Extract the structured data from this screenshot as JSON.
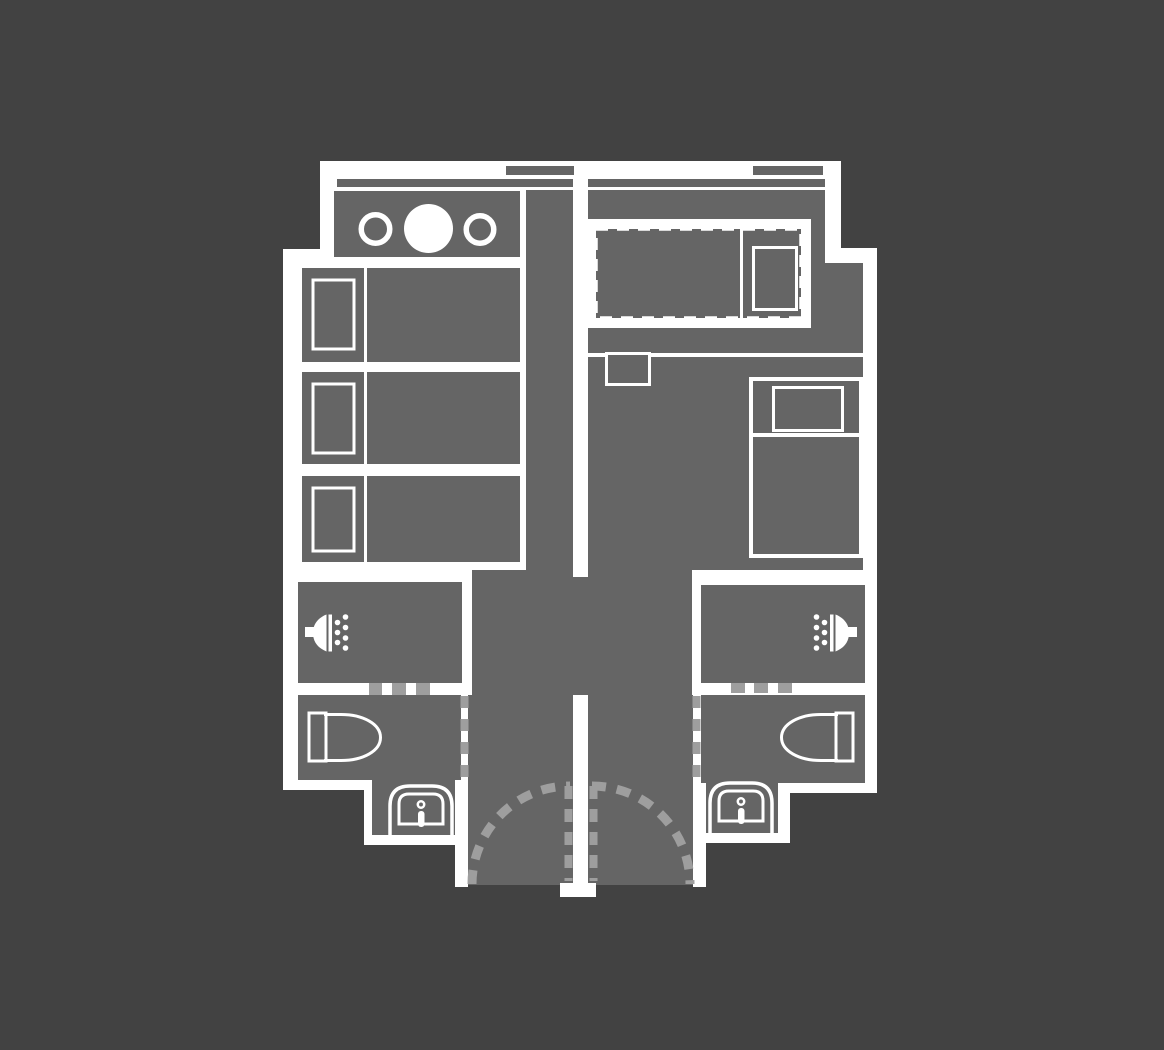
{
  "meta": {
    "description": "floor-plan-of-two-mirrored-suite-units",
    "canvas": {
      "width": 1164,
      "height": 1050
    }
  },
  "palette": {
    "background": "#424242",
    "wall_white": "#ffffff",
    "room_gray": "#656565",
    "dash_gray": "#9e9e9e"
  },
  "shapes": [
    {
      "name": "top-wall-band",
      "kind": "rect",
      "x": 320,
      "y": 161,
      "w": 521,
      "h": 29,
      "fill": "#ffffff"
    },
    {
      "name": "left-upper-floor-plate",
      "kind": "rect",
      "x": 320,
      "y": 190,
      "w": 253,
      "h": 59,
      "fill": "#ffffff"
    },
    {
      "name": "left-main-floor-plate",
      "kind": "rect",
      "x": 283,
      "y": 249,
      "w": 290,
      "h": 541,
      "fill": "#ffffff"
    },
    {
      "name": "left-sink-alcove-plate",
      "kind": "rect",
      "x": 364,
      "y": 780,
      "w": 104,
      "h": 65,
      "fill": "#ffffff"
    },
    {
      "name": "right-upper-floor-plate",
      "kind": "rect",
      "x": 573,
      "y": 190,
      "w": 268,
      "h": 58,
      "fill": "#ffffff"
    },
    {
      "name": "right-main-floor-plate",
      "kind": "rect",
      "x": 573,
      "y": 248,
      "w": 304,
      "h": 535,
      "fill": "#ffffff"
    },
    {
      "name": "right-sink-alcove-plate",
      "kind": "rect",
      "x": 693,
      "y": 783,
      "w": 97,
      "h": 60,
      "fill": "#ffffff"
    },
    {
      "name": "vestibule-upper-floor",
      "kind": "rect",
      "x": 472,
      "y": 570,
      "w": 220,
      "h": 125,
      "fill": "#656565"
    },
    {
      "name": "vestibule-lower-floor",
      "kind": "rect",
      "x": 468,
      "y": 695,
      "w": 225,
      "h": 190,
      "fill": "#656565"
    },
    {
      "name": "window-tab-left",
      "kind": "rect",
      "x": 506,
      "y": 166,
      "w": 68,
      "h": 9,
      "fill": "#656565"
    },
    {
      "name": "window-strip-left",
      "kind": "rect",
      "x": 337,
      "y": 179,
      "w": 236,
      "h": 8,
      "fill": "#656565"
    },
    {
      "name": "window-tab-right",
      "kind": "rect",
      "x": 753,
      "y": 166,
      "w": 70,
      "h": 9,
      "fill": "#656565"
    },
    {
      "name": "window-strip-right",
      "kind": "rect",
      "x": 588,
      "y": 179,
      "w": 237,
      "h": 8,
      "fill": "#656565"
    },
    {
      "name": "kitchen-counter",
      "kind": "rect",
      "x": 334,
      "y": 191,
      "w": 186,
      "h": 66,
      "fill": "#656565"
    },
    {
      "name": "left-hallway-floor",
      "kind": "rect",
      "x": 526,
      "y": 190,
      "w": 47,
      "h": 380,
      "fill": "#656565"
    },
    {
      "name": "left-bed-1",
      "kind": "rect",
      "x": 302,
      "y": 268,
      "w": 218,
      "h": 94,
      "fill": "#656565"
    },
    {
      "name": "left-bed-2",
      "kind": "rect",
      "x": 302,
      "y": 372,
      "w": 218,
      "h": 92,
      "fill": "#656565"
    },
    {
      "name": "left-bed-3",
      "kind": "rect",
      "x": 302,
      "y": 476,
      "w": 218,
      "h": 86,
      "fill": "#656565"
    },
    {
      "name": "right-room-upper-floor",
      "kind": "rect",
      "x": 588,
      "y": 190,
      "w": 237,
      "h": 73,
      "fill": "#656565"
    },
    {
      "name": "right-room-main-floor",
      "kind": "rect",
      "x": 588,
      "y": 263,
      "w": 275,
      "h": 307,
      "fill": "#656565"
    },
    {
      "name": "left-shower-room-floor",
      "kind": "rect",
      "x": 298,
      "y": 582,
      "w": 164,
      "h": 101,
      "fill": "#656565"
    },
    {
      "name": "right-shower-room-floor",
      "kind": "rect",
      "x": 701,
      "y": 585,
      "w": 164,
      "h": 98,
      "fill": "#656565"
    },
    {
      "name": "left-toilet-room-floor",
      "kind": "rect",
      "x": 298,
      "y": 695,
      "w": 163,
      "h": 85,
      "fill": "#656565"
    },
    {
      "name": "left-sink-alcove-floor",
      "kind": "rect",
      "x": 372,
      "y": 695,
      "w": 83,
      "h": 140,
      "fill": "#656565"
    },
    {
      "name": "right-toilet-room-floor",
      "kind": "rect",
      "x": 701,
      "y": 695,
      "w": 164,
      "h": 88,
      "fill": "#656565"
    },
    {
      "name": "right-sink-alcove-floor",
      "kind": "rect",
      "x": 701,
      "y": 695,
      "w": 77,
      "h": 138,
      "fill": "#656565"
    },
    {
      "name": "center-wall-upper",
      "kind": "rect",
      "x": 573,
      "y": 190,
      "w": 15,
      "h": 387,
      "fill": "#ffffff"
    },
    {
      "name": "center-wall-lower",
      "kind": "rect",
      "x": 573,
      "y": 695,
      "w": 15,
      "h": 192,
      "fill": "#ffffff"
    },
    {
      "name": "center-wall-foot",
      "kind": "rect",
      "x": 560,
      "y": 883,
      "w": 36,
      "h": 14,
      "fill": "#ffffff"
    },
    {
      "name": "left-entry-wall-stub",
      "kind": "rect",
      "x": 455,
      "y": 783,
      "w": 13,
      "h": 104,
      "fill": "#ffffff"
    },
    {
      "name": "right-entry-wall-stub",
      "kind": "rect",
      "x": 693,
      "y": 783,
      "w": 13,
      "h": 104,
      "fill": "#ffffff"
    },
    {
      "name": "right-toilet-room-bottom-wall",
      "kind": "rect",
      "x": 790,
      "y": 783,
      "w": 87,
      "h": 10,
      "fill": "#ffffff"
    },
    {
      "name": "stove-burner-ring-left",
      "kind": "circle",
      "cx": 375.5,
      "cy": 229,
      "r": 14.25,
      "fill": "none",
      "stroke": "#ffffff",
      "sw": 5.5
    },
    {
      "name": "stove-burner-disc-center",
      "kind": "circle",
      "cx": 428.5,
      "cy": 228.5,
      "r": 24.5,
      "fill": "#ffffff"
    },
    {
      "name": "stove-burner-ring-right",
      "kind": "circle",
      "cx": 480,
      "cy": 229.5,
      "r": 13.75,
      "fill": "none",
      "stroke": "#ffffff",
      "sw": 5.5
    },
    {
      "name": "left-bed-1-divider",
      "kind": "rect",
      "x": 364,
      "y": 268,
      "w": 3,
      "h": 94,
      "fill": "#ffffff"
    },
    {
      "name": "left-bed-2-divider",
      "kind": "rect",
      "x": 364,
      "y": 372,
      "w": 3,
      "h": 92,
      "fill": "#ffffff"
    },
    {
      "name": "left-bed-3-divider",
      "kind": "rect",
      "x": 364,
      "y": 476,
      "w": 3,
      "h": 86,
      "fill": "#ffffff"
    },
    {
      "name": "left-bed-1-pillow",
      "kind": "rect",
      "x": 313,
      "y": 280,
      "w": 41,
      "h": 69,
      "fill": "none",
      "stroke": "#ffffff",
      "sw": 3
    },
    {
      "name": "left-bed-2-pillow",
      "kind": "rect",
      "x": 313,
      "y": 384,
      "w": 41,
      "h": 69,
      "fill": "none",
      "stroke": "#ffffff",
      "sw": 3
    },
    {
      "name": "left-bed-3-pillow",
      "kind": "rect",
      "x": 313,
      "y": 488,
      "w": 41,
      "h": 63,
      "fill": "none",
      "stroke": "#ffffff",
      "sw": 3
    },
    {
      "name": "dashed-bed-panel",
      "kind": "rect",
      "x": 588,
      "y": 219,
      "w": 223,
      "h": 109,
      "fill": "#ffffff"
    },
    {
      "name": "dashed-bed-outline",
      "kind": "rect",
      "x": 596,
      "y": 229,
      "w": 205,
      "h": 89,
      "fill": "#656565",
      "stroke": "#ffffff",
      "sw": 3.5,
      "dash": "12 9"
    },
    {
      "name": "dashed-bed-divider",
      "kind": "rect",
      "x": 740,
      "y": 229,
      "w": 3,
      "h": 89,
      "fill": "#ffffff"
    },
    {
      "name": "dashed-bed-pillow",
      "kind": "rect",
      "x": 753.5,
      "y": 247.5,
      "w": 43,
      "h": 62,
      "fill": "none",
      "stroke": "#ffffff",
      "sw": 3
    },
    {
      "name": "right-room-wall-line",
      "kind": "rect",
      "x": 588,
      "y": 353,
      "w": 275,
      "h": 4,
      "fill": "#ffffff"
    },
    {
      "name": "right-room-nightstand",
      "kind": "rect",
      "x": 606.5,
      "y": 353.5,
      "w": 43,
      "h": 31,
      "fill": "#656565",
      "stroke": "#ffffff",
      "sw": 3
    },
    {
      "name": "right-bed-outline",
      "kind": "rect",
      "x": 751,
      "y": 379,
      "w": 110,
      "h": 177,
      "fill": "none",
      "stroke": "#ffffff",
      "sw": 4
    },
    {
      "name": "right-bed-pillow",
      "kind": "rect",
      "x": 773.5,
      "y": 387.5,
      "w": 69,
      "h": 43,
      "fill": "none",
      "stroke": "#ffffff",
      "sw": 3
    },
    {
      "name": "right-bed-divider",
      "kind": "rect",
      "x": 753,
      "y": 433,
      "w": 106,
      "h": 4,
      "fill": "#ffffff"
    },
    {
      "name": "left-shower-door-dash-1",
      "kind": "rect",
      "x": 369,
      "y": 683,
      "w": 13,
      "h": 12,
      "fill": "#9e9e9e"
    },
    {
      "name": "left-shower-door-dash-2",
      "kind": "rect",
      "x": 392,
      "y": 683,
      "w": 14,
      "h": 12,
      "fill": "#9e9e9e"
    },
    {
      "name": "left-shower-door-dash-3",
      "kind": "rect",
      "x": 416,
      "y": 683,
      "w": 14,
      "h": 12,
      "fill": "#9e9e9e"
    },
    {
      "name": "right-shower-door-dash-1",
      "kind": "rect",
      "x": 731,
      "y": 683,
      "w": 14,
      "h": 10,
      "fill": "#9e9e9e"
    },
    {
      "name": "right-shower-door-dash-2",
      "kind": "rect",
      "x": 754,
      "y": 683,
      "w": 14,
      "h": 10,
      "fill": "#9e9e9e"
    },
    {
      "name": "right-shower-door-dash-3",
      "kind": "rect",
      "x": 778,
      "y": 683,
      "w": 14,
      "h": 10,
      "fill": "#9e9e9e"
    },
    {
      "name": "left-partition-dash-line",
      "kind": "line",
      "x1": 464.5,
      "y1": 696,
      "x2": 464.5,
      "y2": 778,
      "stroke": "#9e9e9e",
      "sw": 8,
      "dash": "12 11"
    },
    {
      "name": "right-partition-dash-line",
      "kind": "line",
      "x1": 696.5,
      "y1": 696,
      "x2": 696.5,
      "y2": 778,
      "stroke": "#9e9e9e",
      "sw": 8,
      "dash": "12 11"
    },
    {
      "name": "left-door-leaf-dash-line",
      "kind": "line",
      "x1": 568.5,
      "y1": 786,
      "x2": 568.5,
      "y2": 881,
      "stroke": "#9e9e9e",
      "sw": 8,
      "dash": "13 10"
    },
    {
      "name": "right-door-leaf-dash-line",
      "kind": "line",
      "x1": 593.5,
      "y1": 786,
      "x2": 593.5,
      "y2": 881,
      "stroke": "#9e9e9e",
      "sw": 8,
      "dash": "13 10"
    },
    {
      "name": "left-door-swing-arc",
      "kind": "path",
      "d": "M472 884 A98 98 0 0 1 570 786",
      "fill": "none",
      "stroke": "#9e9e9e",
      "sw": 9,
      "dash": "14 11"
    },
    {
      "name": "right-door-swing-arc",
      "kind": "path",
      "d": "M592 786 A98 98 0 0 1 690 884",
      "fill": "none",
      "stroke": "#9e9e9e",
      "sw": 9,
      "dash": "14 11"
    },
    {
      "name": "left-shower-head-arm",
      "kind": "rect",
      "x": 305,
      "y": 627,
      "w": 11,
      "h": 10,
      "fill": "#ffffff"
    },
    {
      "name": "left-shower-head-dome",
      "kind": "path",
      "d": "M326.5 614.5 C318 618 313 624 313 633 C313 642 318 648 326.5 651.5 Z",
      "fill": "#ffffff"
    },
    {
      "name": "left-shower-head-plate",
      "kind": "rect",
      "x": 328.5,
      "y": 614.5,
      "w": 3.5,
      "h": 37,
      "fill": "#ffffff"
    },
    {
      "name": "left-shower-drop-a1",
      "kind": "circle",
      "cx": 337.5,
      "cy": 622.5,
      "r": 2.8,
      "fill": "#ffffff"
    },
    {
      "name": "left-shower-drop-a2",
      "kind": "circle",
      "cx": 337.5,
      "cy": 632.5,
      "r": 2.8,
      "fill": "#ffffff"
    },
    {
      "name": "left-shower-drop-a3",
      "kind": "circle",
      "cx": 337.5,
      "cy": 642.5,
      "r": 2.8,
      "fill": "#ffffff"
    },
    {
      "name": "left-shower-drop-b1",
      "kind": "circle",
      "cx": 345.5,
      "cy": 617,
      "r": 2.8,
      "fill": "#ffffff"
    },
    {
      "name": "left-shower-drop-b2",
      "kind": "circle",
      "cx": 345.5,
      "cy": 627.5,
      "r": 2.8,
      "fill": "#ffffff"
    },
    {
      "name": "left-shower-drop-b3",
      "kind": "circle",
      "cx": 345.5,
      "cy": 638,
      "r": 2.8,
      "fill": "#ffffff"
    },
    {
      "name": "left-shower-drop-b4",
      "kind": "circle",
      "cx": 345.5,
      "cy": 648,
      "r": 2.8,
      "fill": "#ffffff"
    },
    {
      "name": "right-shower-head-arm",
      "kind": "rect",
      "x": 846,
      "y": 627,
      "w": 11,
      "h": 10,
      "fill": "#ffffff"
    },
    {
      "name": "right-shower-head-dome",
      "kind": "path",
      "d": "M835.5 614.5 C844 618 849 624 849 633 C849 642 844 648 835.5 651.5 Z",
      "fill": "#ffffff"
    },
    {
      "name": "right-shower-head-plate",
      "kind": "rect",
      "x": 830,
      "y": 614.5,
      "w": 3.5,
      "h": 37,
      "fill": "#ffffff"
    },
    {
      "name": "right-shower-drop-a1",
      "kind": "circle",
      "cx": 824.5,
      "cy": 622.5,
      "r": 2.8,
      "fill": "#ffffff"
    },
    {
      "name": "right-shower-drop-a2",
      "kind": "circle",
      "cx": 824.5,
      "cy": 632.5,
      "r": 2.8,
      "fill": "#ffffff"
    },
    {
      "name": "right-shower-drop-a3",
      "kind": "circle",
      "cx": 824.5,
      "cy": 642.5,
      "r": 2.8,
      "fill": "#ffffff"
    },
    {
      "name": "right-shower-drop-b1",
      "kind": "circle",
      "cx": 816.5,
      "cy": 617,
      "r": 2.8,
      "fill": "#ffffff"
    },
    {
      "name": "right-shower-drop-b2",
      "kind": "circle",
      "cx": 816.5,
      "cy": 627.5,
      "r": 2.8,
      "fill": "#ffffff"
    },
    {
      "name": "right-shower-drop-b3",
      "kind": "circle",
      "cx": 816.5,
      "cy": 638,
      "r": 2.8,
      "fill": "#ffffff"
    },
    {
      "name": "right-shower-drop-b4",
      "kind": "circle",
      "cx": 816.5,
      "cy": 648,
      "r": 2.8,
      "fill": "#ffffff"
    },
    {
      "name": "left-toilet-tank",
      "kind": "rect",
      "x": 309,
      "y": 713,
      "w": 17,
      "h": 48,
      "fill": "none",
      "stroke": "#ffffff",
      "sw": 3
    },
    {
      "name": "left-toilet-bowl",
      "kind": "path",
      "d": "M324 714.5 L341 714.5 C363 714.5 380.5 724 380.5 737.5 C380.5 751 363 760.5 341 760.5 L324 760.5",
      "fill": "none",
      "stroke": "#ffffff",
      "sw": 3
    },
    {
      "name": "right-toilet-tank",
      "kind": "rect",
      "x": 836,
      "y": 713,
      "w": 17,
      "h": 48,
      "fill": "none",
      "stroke": "#ffffff",
      "sw": 3
    },
    {
      "name": "right-toilet-bowl",
      "kind": "path",
      "d": "M838 714.5 L821 714.5 C799 714.5 781.5 724 781.5 737.5 C781.5 751 799 760.5 821 760.5 L838 760.5",
      "fill": "none",
      "stroke": "#ffffff",
      "sw": 3
    },
    {
      "name": "left-sink-pedestal",
      "kind": "path",
      "d": "M390 844 L390 806 Q390 786 410 786 L432 786 Q452 786 452 806 L452 844",
      "fill": "none",
      "stroke": "#ffffff",
      "sw": 3.5
    },
    {
      "name": "left-sink-basin",
      "kind": "path",
      "d": "M399 824 L399 804 Q399 794 409 794 L433 794 Q443 794 443 804 L443 824 Z",
      "fill": "none",
      "stroke": "#ffffff",
      "sw": 3
    },
    {
      "name": "left-sink-faucet-dot",
      "kind": "circle",
      "cx": 421,
      "cy": 804.5,
      "r": 3.2,
      "fill": "none",
      "stroke": "#ffffff",
      "sw": 2.5
    },
    {
      "name": "left-sink-faucet-stem",
      "kind": "rect",
      "x": 418,
      "y": 811,
      "w": 6.5,
      "h": 16,
      "rx": 3,
      "fill": "#ffffff"
    },
    {
      "name": "right-sink-pedestal",
      "kind": "path",
      "d": "M710 841 L710 803 Q710 783 730 783 L752 783 Q772 783 772 803 L772 841",
      "fill": "none",
      "stroke": "#ffffff",
      "sw": 3.5
    },
    {
      "name": "right-sink-basin",
      "kind": "path",
      "d": "M719 821 L719 801 Q719 791 729 791 L753 791 Q763 791 763 801 L763 821 Z",
      "fill": "none",
      "stroke": "#ffffff",
      "sw": 3
    },
    {
      "name": "right-sink-faucet-dot",
      "kind": "circle",
      "cx": 741,
      "cy": 801.5,
      "r": 3.2,
      "fill": "none",
      "stroke": "#ffffff",
      "sw": 2.5
    },
    {
      "name": "right-sink-faucet-stem",
      "kind": "rect",
      "x": 738,
      "y": 808,
      "w": 6.5,
      "h": 16,
      "rx": 3,
      "fill": "#ffffff"
    }
  ]
}
